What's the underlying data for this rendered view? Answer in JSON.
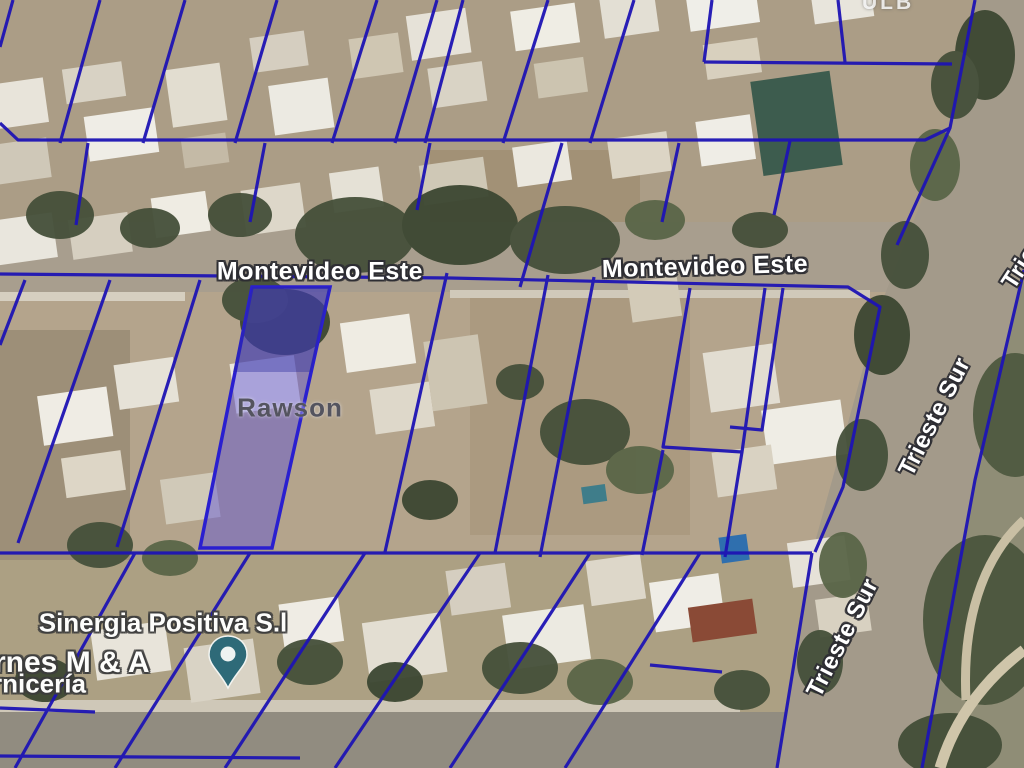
{
  "map": {
    "locality": {
      "label": "Rawson"
    },
    "streets": {
      "montevideo_1": "Montevideo Este",
      "montevideo_2": "Montevideo Este",
      "trieste_1": "Trieste Sur",
      "trieste_2": "Trieste Sur",
      "trieste_partial": "Trieste"
    },
    "pois": {
      "business_main": "Sinergia Positiva S.l",
      "business_left_cut_1": "rnes M & A",
      "business_left_cut_2": "rnicería",
      "label_top_partial": "ULB"
    },
    "colors": {
      "parcel_line": "#1e14b4",
      "highlight_parcel_fill": "#5a50d8",
      "highlight_parcel_stroke": "#2a1fd0",
      "pin": "#2e6a78",
      "road_label_text": "#ffffff",
      "locality_label_text": "#54545f"
    },
    "icons": {
      "pin": "map-pin"
    }
  }
}
